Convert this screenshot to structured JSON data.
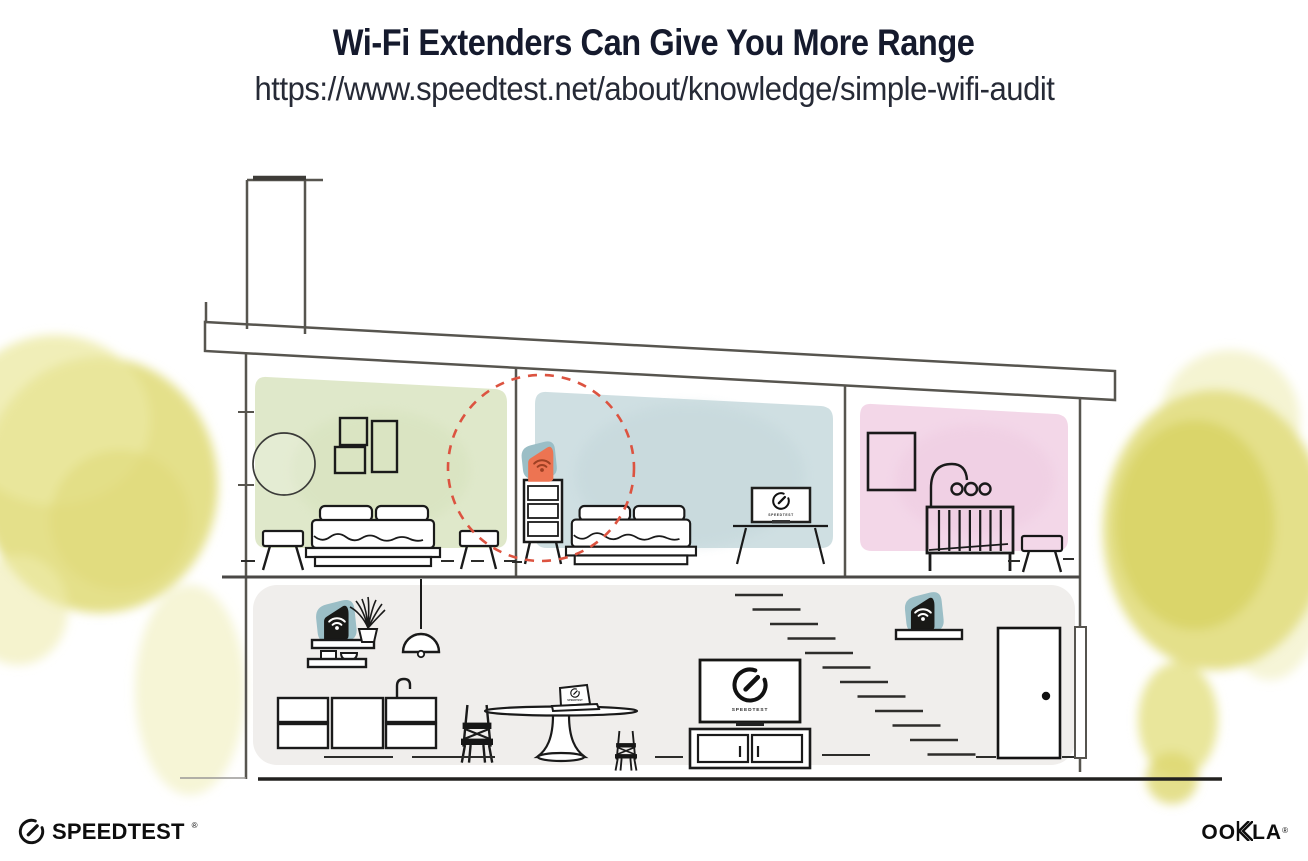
{
  "header": {
    "title": "Wi-Fi Extenders Can Give You More Range",
    "url": "https://www.speedtest.net/about/knowledge/simple-wifi-audit"
  },
  "screens": {
    "tv_bedroom": "SPEEDTEST",
    "tv_living": "SPEEDTEST",
    "laptop": "SPEEDTEST"
  },
  "footer": {
    "speedtest": "SPEEDTEST",
    "speedtest_mark": "®",
    "ookla_prefix": "OO",
    "ookla_suffix": "LA",
    "ookla_mark": "®"
  },
  "illustration": {
    "description": "Cross-section of a single-story-over-basement style house showing a highlighted Wi-Fi extender on an upstairs dresser (dashed coverage circle) plus two routers/extenders downstairs",
    "rooms": [
      "bedroom-green",
      "bedroom-blue",
      "nursery-pink",
      "downstairs-living-kitchen"
    ],
    "devices": [
      "wifi-extender-highlighted",
      "wifi-router-kitchen-shelf",
      "wifi-extender-stairs-shelf"
    ]
  },
  "colors": {
    "accent_orange": "#ED7452",
    "wifi_on_orange": "#9E4023",
    "badge_teal": "#9BBEC6",
    "dashed_circle": "#DC5340",
    "room_green": "#DFE8CA",
    "room_blue": "#CFDFE2",
    "room_pink": "#F3D7E8",
    "floor_gray": "#F0EEEC",
    "tree_yellow": "#E4E08A",
    "structure": "#57554F",
    "title_ink": "#151A2D"
  }
}
